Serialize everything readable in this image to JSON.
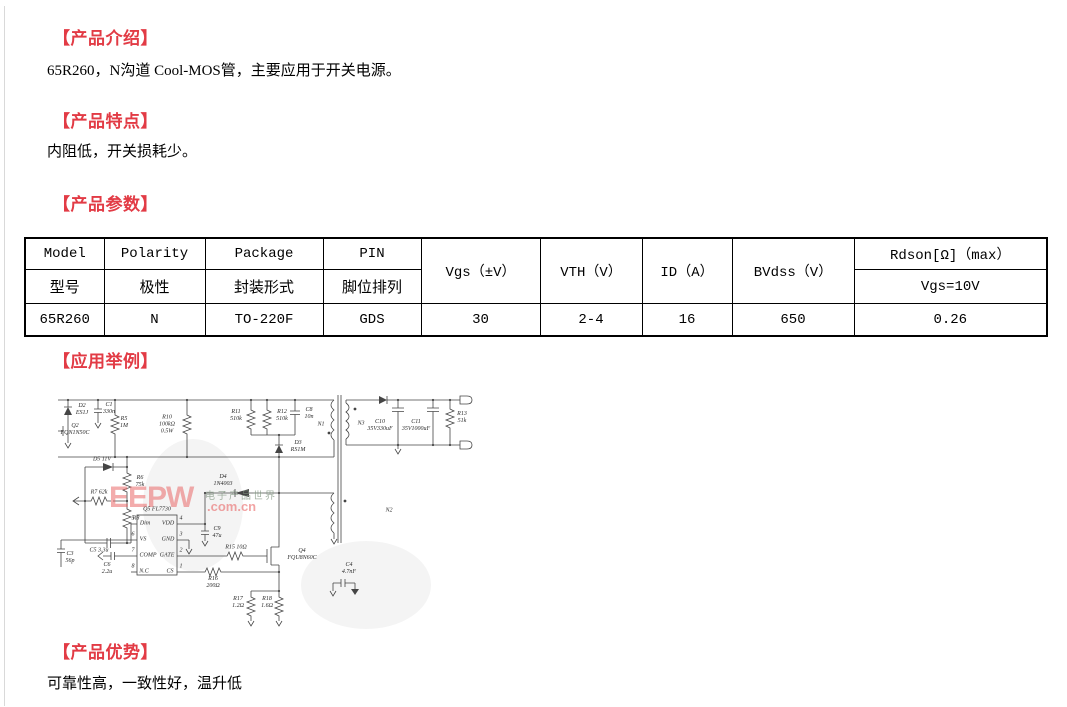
{
  "page": {
    "accent_red": "#e23b45",
    "border_gray": "#d9d9d9",
    "background": "#ffffff"
  },
  "sections": {
    "intro": {
      "heading": "【产品介绍】",
      "body": "65R260，N沟道 Cool-MOS管，主要应用于开关电源。"
    },
    "features": {
      "heading": "【产品特点】",
      "body": "内阻低，开关损耗少。"
    },
    "params": {
      "heading": "【产品参数】"
    },
    "application": {
      "heading": "【应用举例】"
    },
    "advantages": {
      "heading": "【产品优势】",
      "body": "可靠性高，一致性好，温升低"
    }
  },
  "table": {
    "header_row1": [
      "Model",
      "Polarity",
      "Package",
      "PIN",
      "Vgs（±V）",
      "VTH（V）",
      "ID（A）",
      "BVdss（V）",
      "Rdson[Ω]（max）"
    ],
    "header_row2": [
      "型号",
      "极性",
      "封装形式",
      "脚位排列",
      "Vgs=10V"
    ],
    "data_row": [
      "65R260",
      "N",
      "TO-220F",
      "GDS",
      "30",
      "2-4",
      "16",
      "650",
      "0.26"
    ]
  },
  "schematic": {
    "watermark_logo": "EEPW",
    "watermark_domain": ".com.cn",
    "watermark_cn": "电子产品世界",
    "labels": [
      {
        "t": "D2\nES1J",
        "x": 27,
        "y": 27
      },
      {
        "t": "C1\n330n",
        "x": 54,
        "y": 26
      },
      {
        "t": "Q2\nFQN1N50C",
        "x": 20,
        "y": 47
      },
      {
        "t": "R5\n1M",
        "x": 69,
        "y": 40
      },
      {
        "t": "R10\n100kΩ\n0.5W",
        "x": 112,
        "y": 42
      },
      {
        "t": "R11\n510k",
        "x": 181,
        "y": 33
      },
      {
        "t": "R12\n510k",
        "x": 227,
        "y": 33
      },
      {
        "t": "C8\n10n",
        "x": 254,
        "y": 31
      },
      {
        "t": "N1",
        "x": 266,
        "y": 42
      },
      {
        "t": "D3\nRS1M",
        "x": 243,
        "y": 64
      },
      {
        "t": "D5 11V",
        "x": 47,
        "y": 77
      },
      {
        "t": "R6\n75k",
        "x": 85,
        "y": 99
      },
      {
        "t": "R7 62k",
        "x": 44,
        "y": 110
      },
      {
        "t": "R8",
        "x": 81,
        "y": 136
      },
      {
        "t": "C5 3.3u",
        "x": 44,
        "y": 168
      },
      {
        "t": "C3\n56p",
        "x": 15,
        "y": 175
      },
      {
        "t": "C6\n2.2u",
        "x": 52,
        "y": 186
      },
      {
        "t": "Q5 FL7730",
        "x": 102,
        "y": 127
      },
      {
        "t": "Dim",
        "x": 90,
        "y": 141
      },
      {
        "t": "VS",
        "x": 88,
        "y": 157
      },
      {
        "t": "COMP",
        "x": 93,
        "y": 173
      },
      {
        "t": "N.C",
        "x": 89,
        "y": 189
      },
      {
        "t": "VDD",
        "x": 113,
        "y": 141
      },
      {
        "t": "GND",
        "x": 113,
        "y": 157
      },
      {
        "t": "GATE",
        "x": 112,
        "y": 173
      },
      {
        "t": "CS",
        "x": 115,
        "y": 189
      },
      {
        "t": "5",
        "x": 78,
        "y": 136
      },
      {
        "t": "6",
        "x": 78,
        "y": 152
      },
      {
        "t": "7",
        "x": 78,
        "y": 168
      },
      {
        "t": "8",
        "x": 78,
        "y": 184
      },
      {
        "t": "4",
        "x": 126,
        "y": 136
      },
      {
        "t": "3",
        "x": 126,
        "y": 152
      },
      {
        "t": "2",
        "x": 126,
        "y": 168
      },
      {
        "t": "1",
        "x": 126,
        "y": 184
      },
      {
        "t": "C9\n47u",
        "x": 162,
        "y": 150
      },
      {
        "t": "D4\n1N4003",
        "x": 168,
        "y": 98
      },
      {
        "t": "R15 10Ω",
        "x": 181,
        "y": 165
      },
      {
        "t": "Q4\nFQU8N60C",
        "x": 247,
        "y": 172
      },
      {
        "t": "R16\n200Ω",
        "x": 158,
        "y": 200
      },
      {
        "t": "R17\n1.2Ω",
        "x": 183,
        "y": 220
      },
      {
        "t": "R18\n1.6Ω",
        "x": 212,
        "y": 220
      },
      {
        "t": "C4\n4.7nF",
        "x": 294,
        "y": 186
      },
      {
        "t": "N2",
        "x": 334,
        "y": 128
      },
      {
        "t": "N3",
        "x": 306,
        "y": 41
      },
      {
        "t": "C10\n35V330uF",
        "x": 325,
        "y": 43
      },
      {
        "t": "C11\n35V1000uF",
        "x": 361,
        "y": 43
      },
      {
        "t": "R13\n51k",
        "x": 407,
        "y": 35
      }
    ]
  }
}
